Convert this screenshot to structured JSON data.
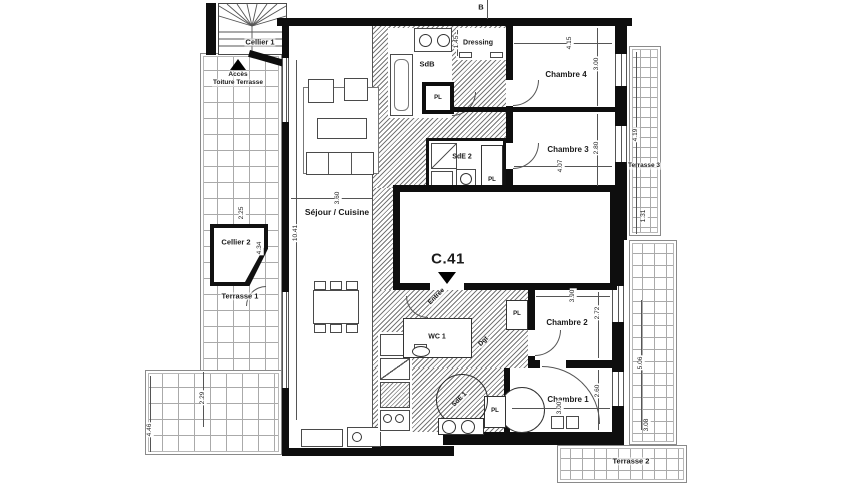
{
  "unit": {
    "label": "C.41"
  },
  "section": {
    "label": "B"
  },
  "rooms": {
    "sejour": "Séjour / Cuisine",
    "chambre1": "Chambre 1",
    "chambre2": "Chambre 2",
    "chambre3": "Chambre 3",
    "chambre4": "Chambre 4",
    "sdb": "SdB",
    "sde1": "SdE 1",
    "sde2": "SdE 2",
    "wc1": "WC 1",
    "dgt": "Dgt",
    "entree": "Entrée",
    "dressing": "Dressing",
    "cellier1": "Cellier 1",
    "cellier2": "Cellier 2",
    "terrasse1": "Terrasse 1",
    "terrasse2": "Terrasse 2",
    "terrasse3": "Terrasse 3",
    "acces1": "Accès",
    "acces2": "Toiture Terrasse",
    "placard": "PL"
  },
  "dims": {
    "sejour_w": "3.60",
    "sejour_h": "10.41",
    "ch4_w": "4.15",
    "ch4_h": "3.00",
    "ch3_w": "4.07",
    "ch3_h": "2.80",
    "ch2_w": "3.90",
    "ch2_h": "2.72",
    "ch1_w": "3.00",
    "ch1_h": "2.60",
    "dressing_h": "1.45",
    "t3_h": "4.19",
    "t3_b": "1.31",
    "right_mid": "5.06",
    "right_bot": "3.08",
    "c2_top": "2.25",
    "c2_diag": "4.34",
    "t1_left": "2.29",
    "t1_bottom": "4.46"
  },
  "colors": {
    "wall": "#0e0e0e",
    "hatch_line": "#777777",
    "grid_line": "#aaaaaa",
    "paper": "#ffffff"
  }
}
